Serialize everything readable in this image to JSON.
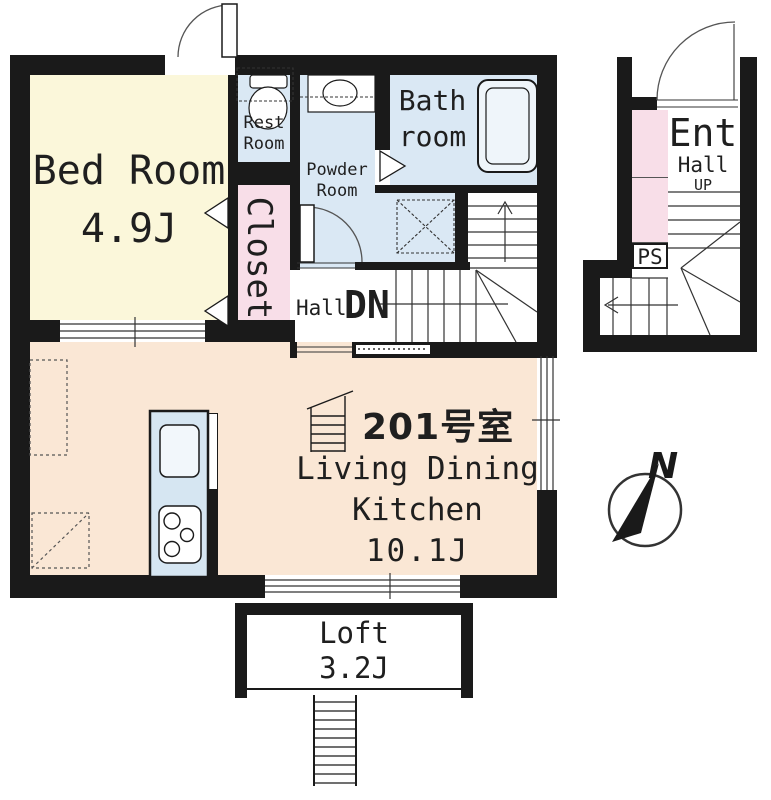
{
  "plan_type": "apartment-floor-plan",
  "unit": {
    "number": "201号室"
  },
  "rooms": {
    "bedroom": {
      "name": "Bed Room",
      "size": "4.9J"
    },
    "restroom": {
      "name_l1": "Rest",
      "name_l2": "Room"
    },
    "powder": {
      "name_l1": "Powder",
      "name_l2": "Room"
    },
    "bathroom": {
      "name_l1": "Bath",
      "name_l2": "room"
    },
    "closet": {
      "name": "Closet"
    },
    "hall": {
      "name": "Hall",
      "stair_direction": "DN"
    },
    "ldk": {
      "name_l1": "Living Dining",
      "name_l2": "Kitchen",
      "size": "10.1J"
    },
    "loft": {
      "name": "Loft",
      "size": "3.2J"
    }
  },
  "annex": {
    "entrance": "Ent",
    "hall": "Hall",
    "stair_direction": "UP",
    "pipe_space": "PS"
  },
  "compass": {
    "north": "N"
  },
  "colors": {
    "wall": "#1a1a1a",
    "bedroom_fill": "#FBF7DA",
    "ldk_fill": "#FAE7D5",
    "wet_area_fill": "#DAE8F4",
    "closet_fill": "#F8DEE8",
    "kitchen_fill": "#D6E6F2",
    "line": "#333333"
  }
}
